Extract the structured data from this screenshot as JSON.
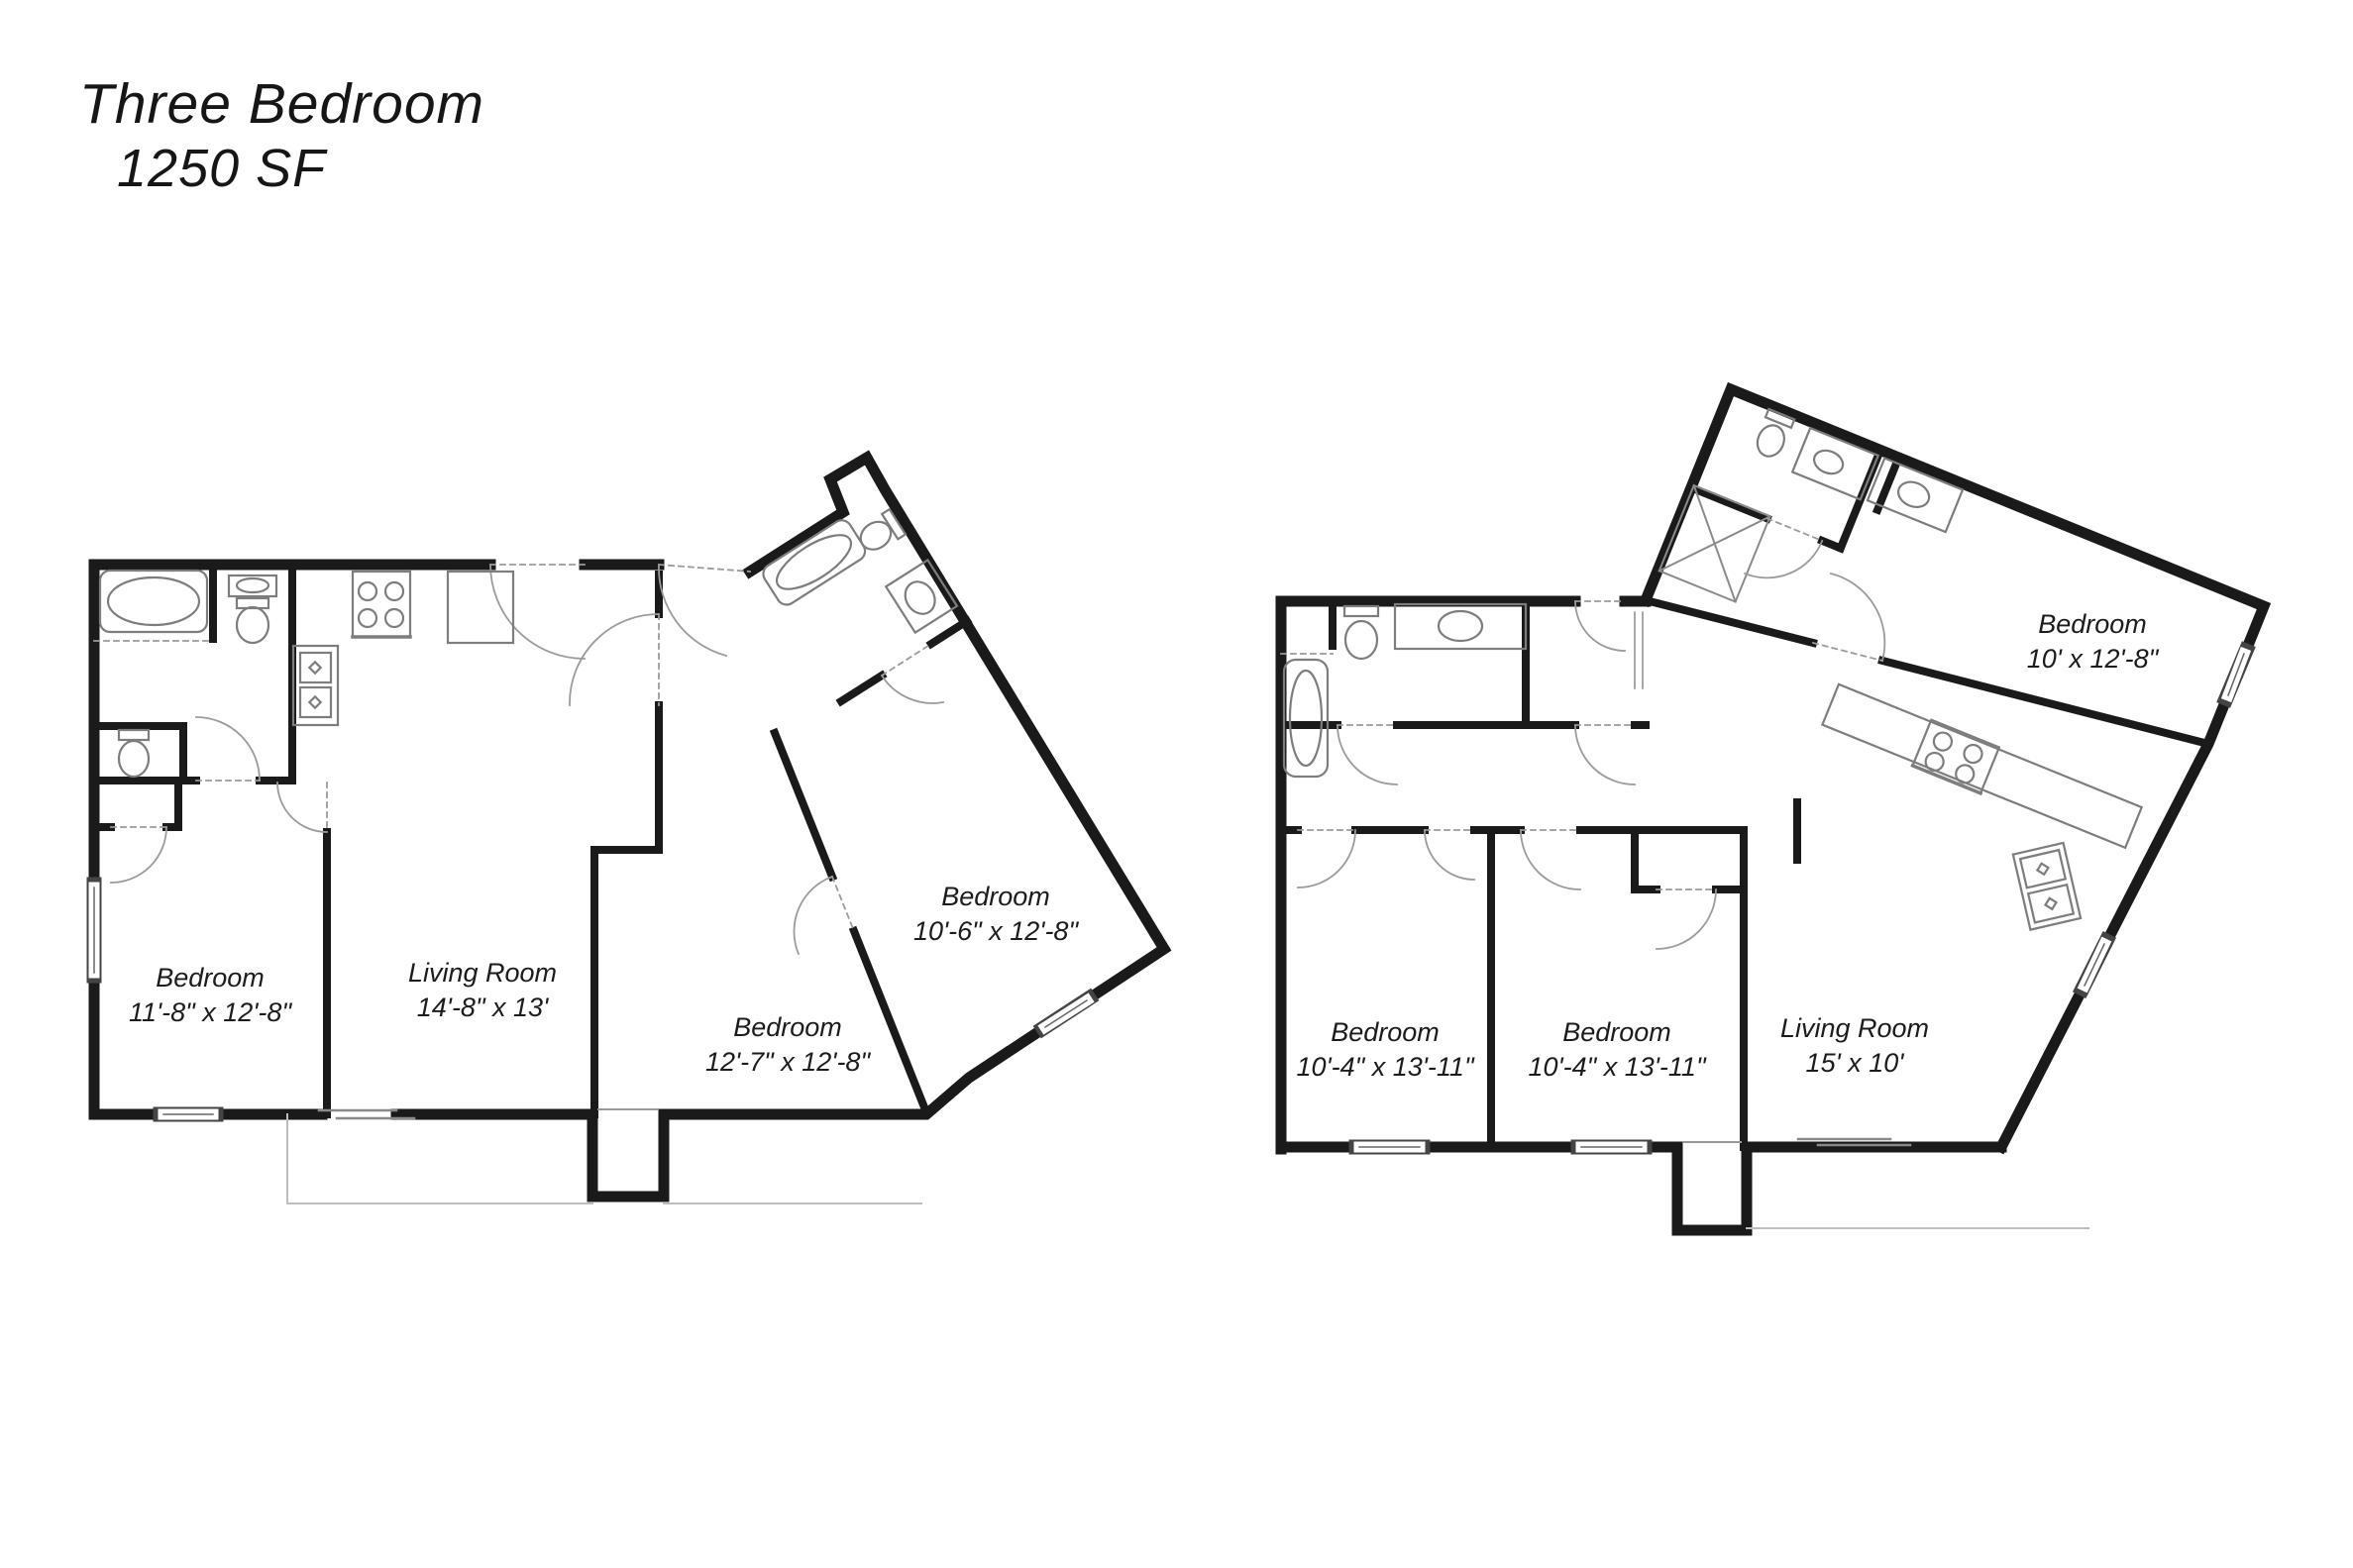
{
  "title": {
    "line1": "Three Bedroom",
    "line2": "1250 SF"
  },
  "plans": [
    {
      "name": "left unit floor plan",
      "rooms": [
        {
          "label": "Bedroom",
          "dimensions": "11'-8\" x 12'-8\""
        },
        {
          "label": "Living Room",
          "dimensions": "14'-8\" x 13'"
        },
        {
          "label": "Bedroom",
          "dimensions": "12'-7\" x 12'-8\""
        },
        {
          "label": "Bedroom",
          "dimensions": "10'-6\" x 12'-8\""
        }
      ]
    },
    {
      "name": "right unit floor plan",
      "rooms": [
        {
          "label": "Bedroom",
          "dimensions": "10'-4\" x 13'-11\""
        },
        {
          "label": "Bedroom",
          "dimensions": "10'-4\" x 13'-11\""
        },
        {
          "label": "Living Room",
          "dimensions": "15' x 10'"
        },
        {
          "label": "Bedroom",
          "dimensions": "10' x 12'-8\""
        }
      ]
    }
  ],
  "colors": {
    "wall": "#1a1a1a",
    "fixture": "#808080",
    "door": "#9b9b9b",
    "background": "#ffffff"
  }
}
